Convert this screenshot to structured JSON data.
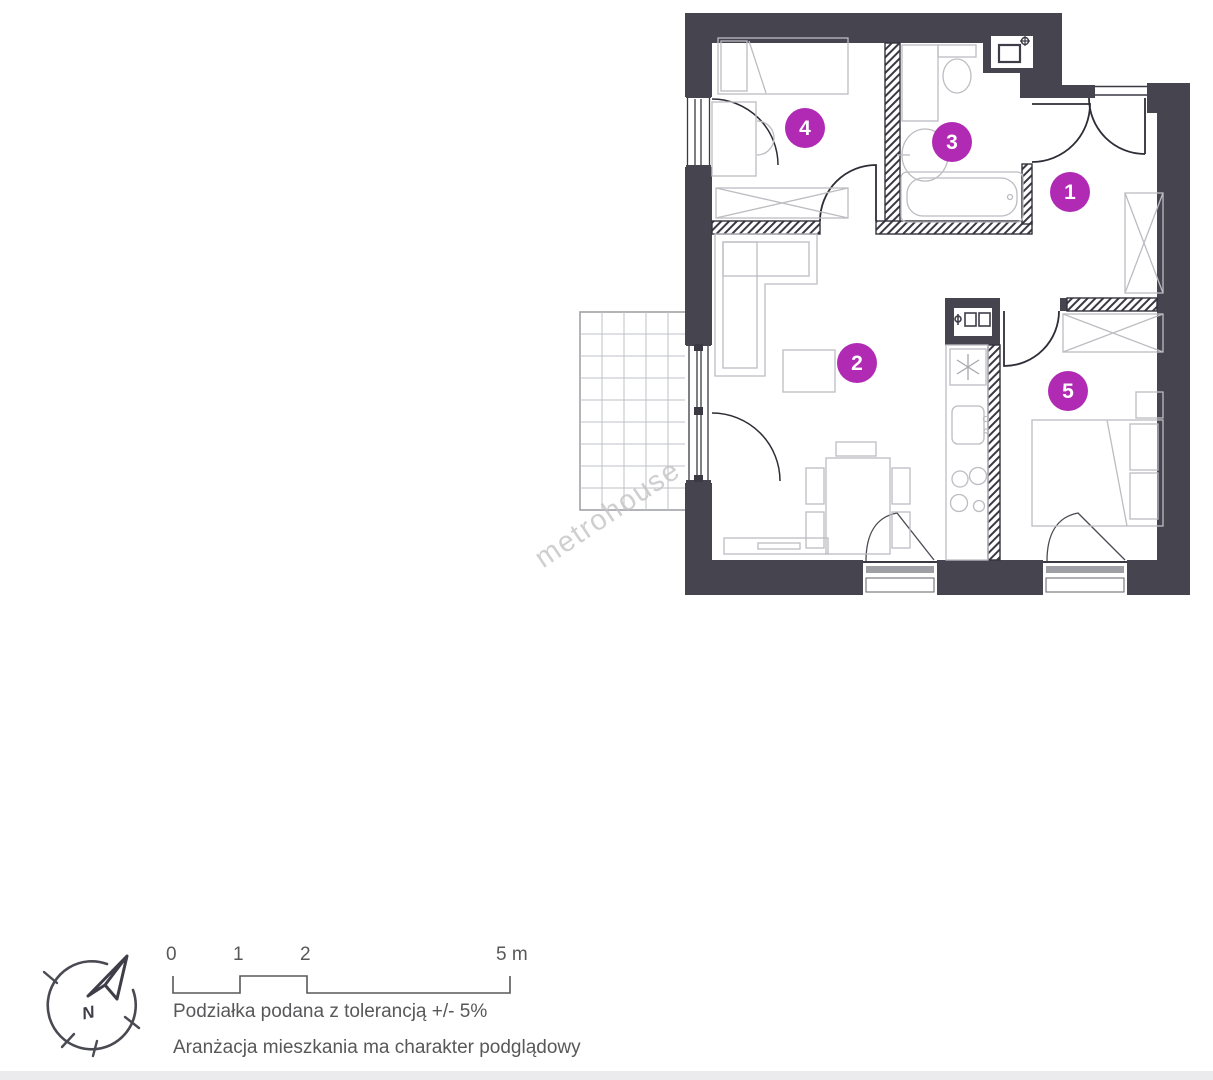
{
  "watermark": "metrohouse",
  "rooms": [
    {
      "number": "1"
    },
    {
      "number": "2"
    },
    {
      "number": "3"
    },
    {
      "number": "4"
    },
    {
      "number": "5"
    }
  ],
  "compass": {
    "north_label": "N"
  },
  "scale_bar": {
    "tick_0": "0",
    "tick_1": "1",
    "tick_2": "2",
    "tick_end": "5 m"
  },
  "notes": {
    "tolerance": "Podziałka podana z tolerancją +/- 5%",
    "arrangement": "Aranżacja mieszkania ma charakter podglądowy"
  },
  "colors": {
    "wall": "#46444f",
    "accent": "#b02ab3",
    "furniture_line": "#bcbcc2",
    "text": "#58585a",
    "watermark": "#c4c4c4"
  }
}
